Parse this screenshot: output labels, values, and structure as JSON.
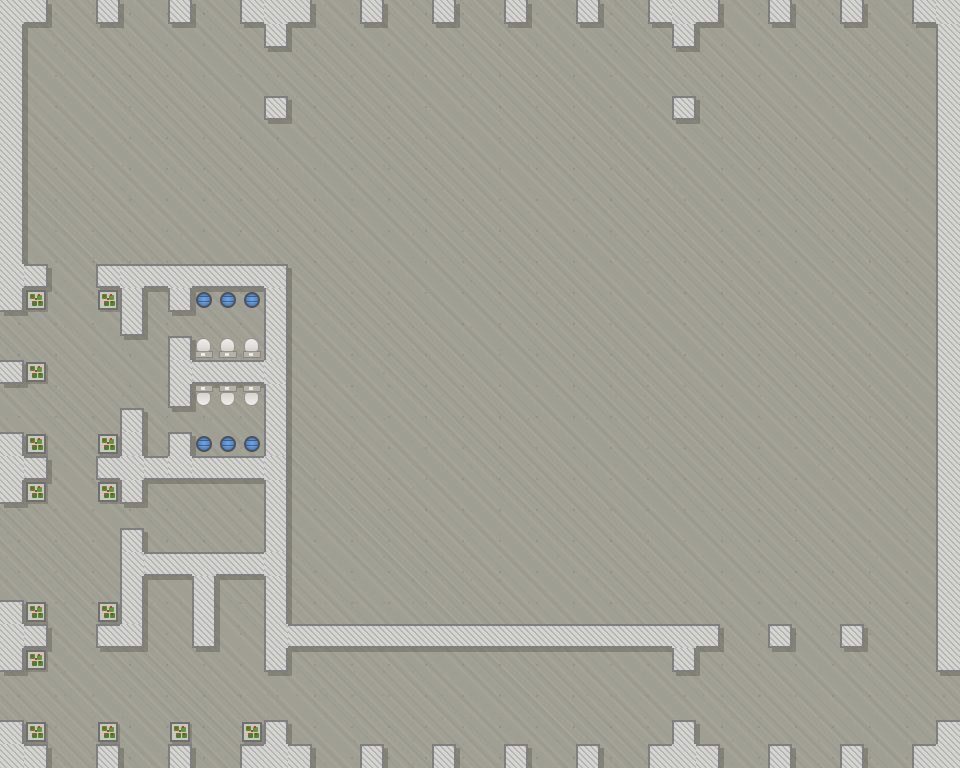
{
  "scene": {
    "type": "top-down-tile-map"
  },
  "grid": {
    "cols": 40,
    "rows": 32,
    "tile_px": 24
  },
  "colors": {
    "floor": "#a09f93",
    "wall_fill": "#d4d4d1",
    "wall_hatch": "#a9a9a5",
    "wall_border": "#7f7f82",
    "wall_shadow": "rgba(64,62,54,0.30)",
    "sink_blue": "#4a80c4",
    "sink_blue_dark": "#2f5da0",
    "toilet_bowl": "#e9e7e3",
    "toilet_tank": "#b7b1ab",
    "plant_green": "#4e8a2f",
    "plant_berry": "#c13a2c",
    "planter_dark": "#6f6f6d",
    "planter_light": "#c9c7c0"
  },
  "walls_by_row": {
    "0": "0-1,4,7,10-12,15,18,21,24,27-29,32,35,38-39",
    "1": "0,11,28,39",
    "2": "0,39",
    "3": "0,39",
    "4": "0,11,28,39",
    "5": "0,39",
    "6": "0,39",
    "7": "0,39",
    "8": "0,39",
    "9": "0,39",
    "10": "0,39",
    "11": "0-1,4-11,39",
    "12": "0,5,7,11,39",
    "13": "5,11,39",
    "14": "7,11,39",
    "15": "0,7-11,39",
    "16": "7,11,39",
    "17": "5,11,39",
    "18": "0,5,7,11,39",
    "19": "0-1,4-11,39",
    "20": "0,5,11,39",
    "21": "11,39",
    "22": "5,11,39",
    "23": "5-11,39",
    "24": "5,8,11,39",
    "25": "0,5,8,11,39",
    "26": "0-1,4-5,8,11-29,32,35,39",
    "27": "0,11,28,39",
    "30": "0,11,28,39",
    "31": "0-1,4,7,10-12,15,18,21,24,27-29,32,35,38-39"
  },
  "fixtures": {
    "sinks": [
      {
        "col": 8,
        "row": 12
      },
      {
        "col": 9,
        "row": 12
      },
      {
        "col": 10,
        "row": 12
      },
      {
        "col": 8,
        "row": 18
      },
      {
        "col": 9,
        "row": 18
      },
      {
        "col": 10,
        "row": 18
      }
    ],
    "toilets": [
      {
        "col": 8,
        "row": 14,
        "facing": "north"
      },
      {
        "col": 9,
        "row": 14,
        "facing": "north"
      },
      {
        "col": 10,
        "row": 14,
        "facing": "north"
      },
      {
        "col": 8,
        "row": 16,
        "facing": "south"
      },
      {
        "col": 9,
        "row": 16,
        "facing": "south"
      },
      {
        "col": 10,
        "row": 16,
        "facing": "south"
      }
    ],
    "plants": [
      {
        "col": 1,
        "row": 12
      },
      {
        "col": 4,
        "row": 12
      },
      {
        "col": 1,
        "row": 15
      },
      {
        "col": 1,
        "row": 18
      },
      {
        "col": 4,
        "row": 18
      },
      {
        "col": 1,
        "row": 20
      },
      {
        "col": 4,
        "row": 20
      },
      {
        "col": 1,
        "row": 25
      },
      {
        "col": 4,
        "row": 25
      },
      {
        "col": 1,
        "row": 27
      },
      {
        "col": 1,
        "row": 30
      },
      {
        "col": 4,
        "row": 30
      },
      {
        "col": 7,
        "row": 30
      },
      {
        "col": 10,
        "row": 30
      }
    ]
  }
}
